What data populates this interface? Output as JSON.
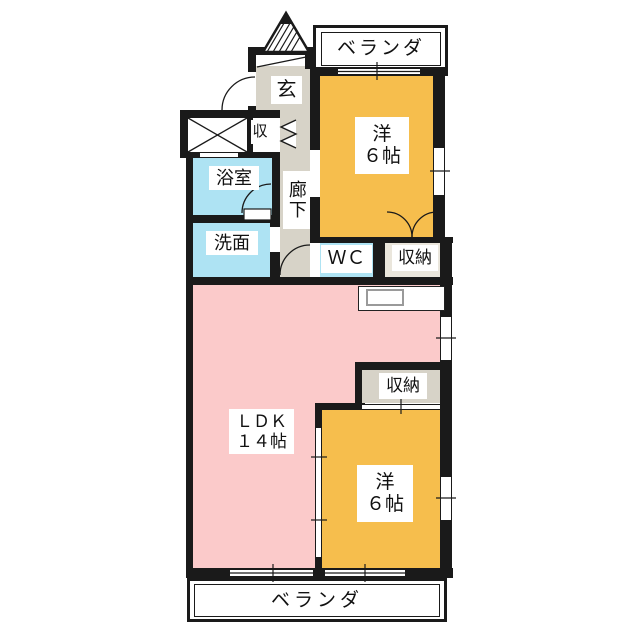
{
  "palette": {
    "wall": "#1a1a1a",
    "western_room_fill": "#f6be4d",
    "ldk_fill": "#fbcaca",
    "wet_area_fill": "#aee3f3",
    "hall_fill": "#d7d3c8",
    "closet_fill": "#eae6dc",
    "outline_white": "#ffffff"
  },
  "rooms": {
    "balcony_top": {
      "label": "ベランダ"
    },
    "entrance": {
      "label": "玄"
    },
    "shoe_closet": {
      "label": "収"
    },
    "bathroom": {
      "label": "浴室"
    },
    "washroom": {
      "label": "洗面"
    },
    "hallway": {
      "label": "廊下"
    },
    "western_top": {
      "name": "洋",
      "size": "６帖"
    },
    "wc": {
      "label": "ＷＣ"
    },
    "closet_top": {
      "label": "収納"
    },
    "ldk": {
      "name": "ＬＤＫ",
      "size": "１４帖"
    },
    "closet_bottom": {
      "label": "収納"
    },
    "western_bottom": {
      "name": "洋",
      "size": "６帖"
    },
    "balcony_bottom": {
      "label": "ベランダ"
    }
  }
}
